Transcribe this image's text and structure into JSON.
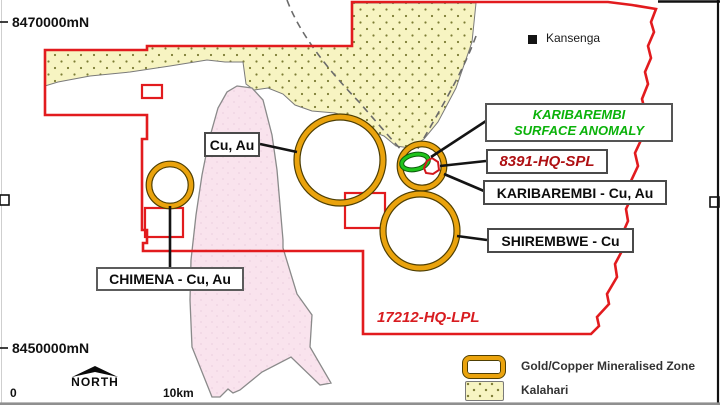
{
  "map": {
    "title_context": "mineral exploration licence map",
    "grid": {
      "top_label": "8470000mN",
      "bottom_label": "8450000mN"
    },
    "place": {
      "kansenga": "Kansenga"
    },
    "labels": {
      "cu_au": "Cu, Au",
      "anomaly_line1": "KARIBAREMBI",
      "anomaly_line2": "SURFACE ANOMALY",
      "spl": "8391-HQ-SPL",
      "karibarembi": "KARIBAREMBI - Cu, Au",
      "shirembwe": "SHIREMBWE - Cu",
      "chimena": "CHIMENA - Cu, Au",
      "license": "17212-HQ-LPL"
    },
    "compass": {
      "label": "NORTH"
    },
    "scale": {
      "start": "0",
      "end": "10km"
    },
    "legend": [
      {
        "swatch": "gold-copper-zone-swatch",
        "label": "Gold/Copper Mineralised Zone"
      },
      {
        "swatch": "kalahari-swatch",
        "label": "Kalahari"
      }
    ],
    "colors": {
      "licence_boundary": "#e21b1e",
      "mineralised_zone_ring": "#eaa30d",
      "surface_anomaly": "#1ec41b",
      "kalahari_fill": "#f7f4c2",
      "pink_unit_fill": "#f9e3ed",
      "anomaly_text": "#0bb20a",
      "spl_text": "#ae1013"
    }
  }
}
